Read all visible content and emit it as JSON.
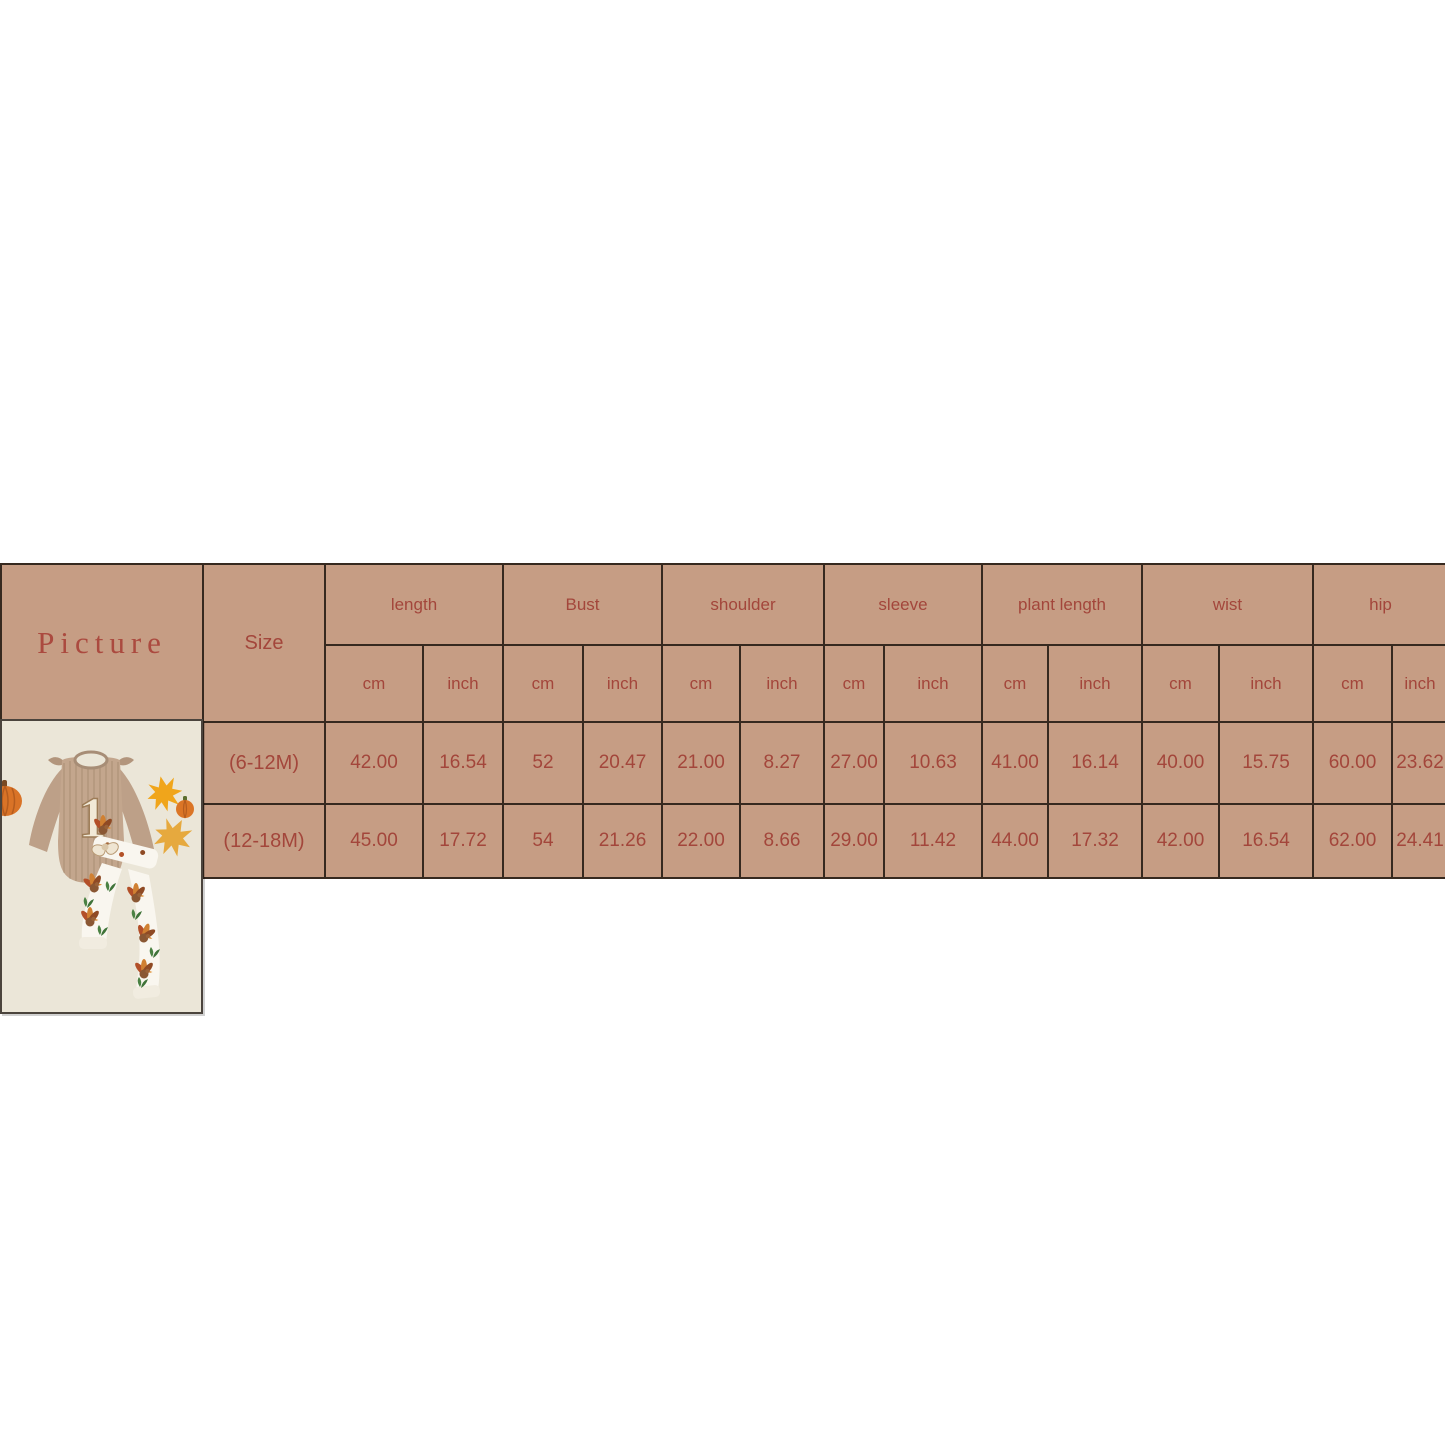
{
  "colors": {
    "cell_bg": "#c69d84",
    "table_text": "#a3463b",
    "picture_text": "#ab4a3f",
    "grid_line": "#36291f",
    "photo_bg": "#ebe6d8",
    "photo_border": "#4b443d",
    "page_bg": "#ffffff"
  },
  "table": {
    "picture_header": "Picture",
    "size_header": "Size",
    "unit_cm": "cm",
    "unit_inch": "inch",
    "groups": [
      "length",
      "Bust",
      "shoulder",
      "sleeve",
      "plant length",
      "wist",
      "hip"
    ],
    "rows": [
      {
        "size": "(6-12M)",
        "values": [
          "42.00",
          "16.54",
          "52",
          "20.47",
          "21.00",
          "8.27",
          "27.00",
          "10.63",
          "41.00",
          "16.14",
          "40.00",
          "15.75",
          "60.00",
          "23.62"
        ]
      },
      {
        "size": "(12-18M)",
        "values": [
          "45.00",
          "17.72",
          "54",
          "21.26",
          "22.00",
          "8.66",
          "29.00",
          "11.42",
          "44.00",
          "17.32",
          "42.00",
          "16.54",
          "62.00",
          "24.41"
        ]
      }
    ]
  },
  "photo": {
    "name": "baby-thanksgiving-outfit-photo"
  },
  "chart_data": {
    "type": "table",
    "title": "Size chart",
    "columns": [
      "Size",
      "length (cm)",
      "length (inch)",
      "Bust (cm)",
      "Bust (inch)",
      "shoulder (cm)",
      "shoulder (inch)",
      "sleeve (cm)",
      "sleeve (inch)",
      "plant length (cm)",
      "plant length (inch)",
      "wist (cm)",
      "wist (inch)",
      "hip (cm)",
      "hip (inch)"
    ],
    "rows": [
      [
        "(6-12M)",
        42.0,
        16.54,
        52,
        20.47,
        21.0,
        8.27,
        27.0,
        10.63,
        41.0,
        16.14,
        40.0,
        15.75,
        60.0,
        23.62
      ],
      [
        "(12-18M)",
        45.0,
        17.72,
        54,
        21.26,
        22.0,
        8.66,
        29.0,
        11.42,
        44.0,
        17.32,
        42.0,
        16.54,
        62.0,
        24.41
      ]
    ]
  }
}
